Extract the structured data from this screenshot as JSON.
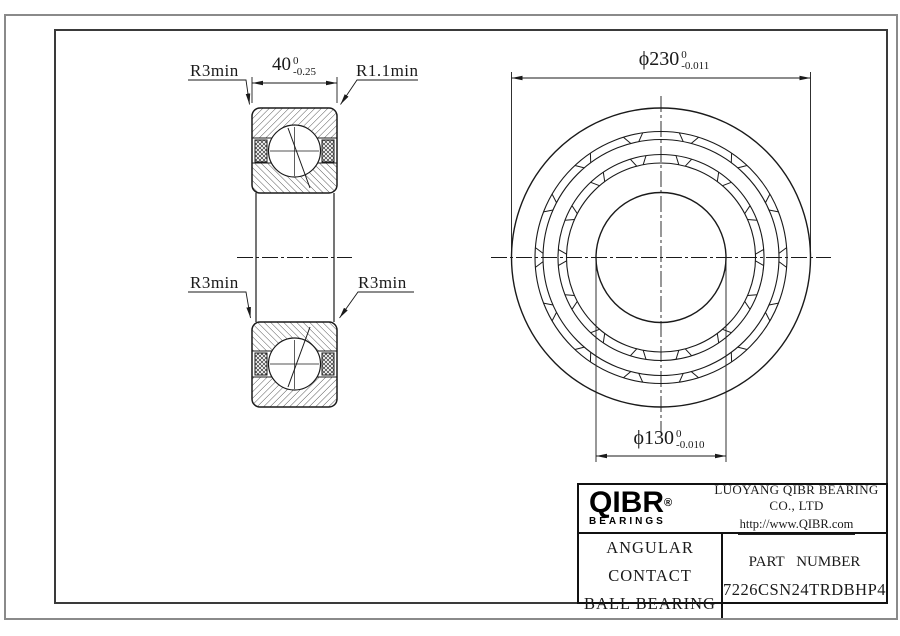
{
  "drawing": {
    "section_view": {
      "labels": {
        "r3_top_left": "R3min",
        "r1_top_right": "R1.1min",
        "r3_bottom_left": "R3min",
        "r3_bottom_right": "R3min"
      },
      "width_dim": {
        "value": "40",
        "upper": "0",
        "lower": "-0.25"
      }
    },
    "front_view": {
      "od_dim": {
        "value": "ϕ230",
        "upper": "0",
        "lower": "-0.011"
      },
      "bore_dim": {
        "value": "ϕ130",
        "upper": "0",
        "lower": "-0.010"
      },
      "pocket_count": 14
    },
    "title_block": {
      "logo_text": "QIBR",
      "logo_reg": "®",
      "logo_sub": "BEARINGS",
      "company": "LUOYANG QIBR BEARING CO., LTD",
      "website": "http://www.QIBR.com",
      "product_line1": "ANGULAR CONTACT",
      "product_line2": "BALL BEARING",
      "part_label": "PART NUMBER",
      "part_number": "7226CSN24TRDBHP4"
    }
  }
}
